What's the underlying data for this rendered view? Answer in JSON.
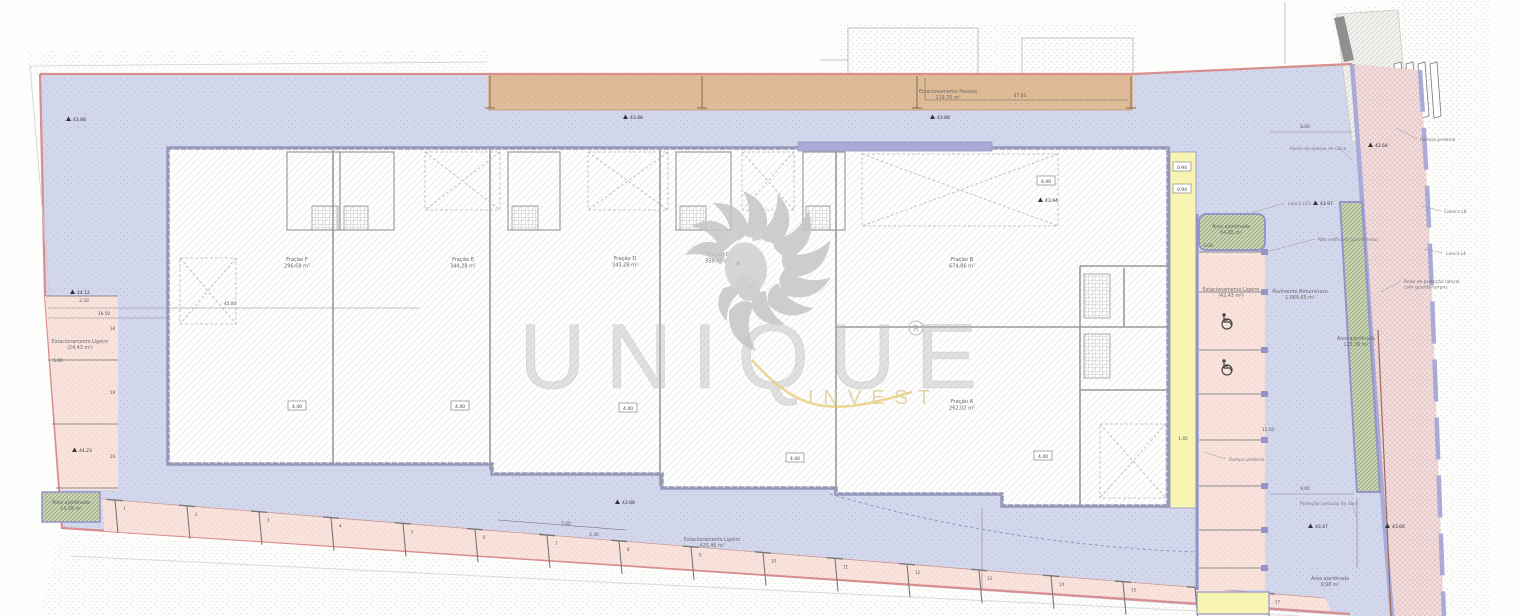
{
  "colors": {
    "site": "#d3d7ec",
    "site_dot": "#a9aed0",
    "boundary": "#d98d8d",
    "pavement_tan": "#dfbc97",
    "building_fill": "#ffffff",
    "wall_purple": "#9395c8",
    "band_purple": "#a9abd6",
    "wall_gray": "#9a9a9a",
    "yellow_walkway": "#f8f4b2",
    "parking_pink": "#f9e2dc",
    "garden_green": "#ccd6b4",
    "garden_line": "#93a37e",
    "road_pink": "#f3e0e0",
    "road_line": "#dfb9b9",
    "watermark_gray": "#c6c6c6",
    "watermark_gold": "#e5c96b",
    "text_gray": "#777777",
    "dim_gray": "#555555"
  },
  "watermark": {
    "brand": "UNIQUE",
    "registered": "®",
    "sub": "INVEST"
  },
  "units": [
    {
      "label": "Fração F",
      "area": "296,68 m²",
      "x": 297,
      "y": 261
    },
    {
      "label": "Fração E",
      "area": "344,28 m²",
      "x": 463,
      "y": 261
    },
    {
      "label": "Fração D",
      "area": "343,28 m²",
      "x": 625,
      "y": 260
    },
    {
      "label": "Fração C",
      "area": "359,40 m²",
      "x": 718,
      "y": 256
    },
    {
      "label": "Fração B",
      "area": "674,86 m²",
      "x": 962,
      "y": 261
    },
    {
      "label": "Fração A",
      "area": "262,02 m²",
      "x": 962,
      "y": 403
    }
  ],
  "area_labels": [
    {
      "lines": [
        "Estacionamento Passeio",
        "219,70 m²"
      ],
      "x": 948,
      "y": 93
    },
    {
      "lines": [
        "Estacionamento Ligeiro",
        "425,46 m²"
      ],
      "x": 712,
      "y": 541
    },
    {
      "lines": [
        "Estacionamento Ligeiro",
        "(42,43 m²)"
      ],
      "x": 1231,
      "y": 291
    },
    {
      "lines": [
        "Estacionamento Ligeiro",
        "(24,43 m²)"
      ],
      "x": 80,
      "y": 343
    },
    {
      "lines": [
        "Área ajardinada",
        "64,85 m²"
      ],
      "x": 1231,
      "y": 228
    },
    {
      "lines": [
        "Área ajardinada",
        "14,39 m²"
      ],
      "x": 71,
      "y": 504
    },
    {
      "lines": [
        "Área ajardinada",
        "115,36 m²"
      ],
      "x": 1356,
      "y": 340
    },
    {
      "lines": [
        "Área ajardinada",
        "9,98 m²"
      ],
      "x": 1330,
      "y": 580
    },
    {
      "lines": [
        "Pavimento Betuminoso",
        "1.664,65 m²"
      ],
      "x": 1300,
      "y": 293
    }
  ],
  "annotations": [
    {
      "lines": [
        "Lancil L43"
      ],
      "x": 1288,
      "y": 205,
      "l": [
        1285,
        203,
        1248,
        214
      ]
    },
    {
      "lines": [
        "Não edificado (pavimento)"
      ],
      "x": 1318,
      "y": 241,
      "l": [
        1315,
        239,
        1266,
        252
      ]
    },
    {
      "lines": [
        "Ponto de acesso de Obra"
      ],
      "x": 1290,
      "y": 150,
      "l": [
        1341,
        150,
        1352,
        160
      ]
    },
    {
      "lines": [
        "Rampa pedonal"
      ],
      "x": 1420,
      "y": 141,
      "l": [
        1417,
        139,
        1396,
        128
      ]
    },
    {
      "lines": [
        "Caleira L6"
      ],
      "x": 1444,
      "y": 213,
      "l": [
        1441,
        211,
        1421,
        206
      ]
    },
    {
      "lines": [
        "Lancil L4"
      ],
      "x": 1446,
      "y": 255,
      "l": [
        1443,
        253,
        1424,
        249
      ]
    },
    {
      "lines": [
        "Rede de proteção lateral",
        "com guarda-corpos"
      ],
      "x": 1404,
      "y": 283,
      "l": [
        1401,
        281,
        1381,
        292
      ]
    },
    {
      "lines": [
        "Rampa pedonal"
      ],
      "x": 1229,
      "y": 461,
      "l": [
        1226,
        459,
        1204,
        452
      ]
    },
    {
      "lines": [
        "Proteção pessoas de obra"
      ],
      "x": 1300,
      "y": 505,
      "l": [
        1352,
        503,
        1357,
        519
      ]
    }
  ],
  "levels": [
    {
      "v": "43.88",
      "x": 66,
      "y": 121
    },
    {
      "v": "43.88",
      "x": 623,
      "y": 119
    },
    {
      "v": "43.88",
      "x": 930,
      "y": 119
    },
    {
      "v": "43.94",
      "x": 1038,
      "y": 202
    },
    {
      "v": "43.97",
      "x": 1313,
      "y": 205
    },
    {
      "v": "43.64",
      "x": 1368,
      "y": 147
    },
    {
      "v": "44.12",
      "x": 70,
      "y": 294
    },
    {
      "v": "44.23",
      "x": 72,
      "y": 452
    },
    {
      "v": "43.88",
      "x": 615,
      "y": 504
    },
    {
      "v": "43.47",
      "x": 1308,
      "y": 528
    },
    {
      "v": "43.66",
      "x": 1385,
      "y": 528
    }
  ],
  "dims": [
    {
      "t": "47.65",
      "x": 1020,
      "y": 97
    },
    {
      "t": "45.00",
      "x": 230,
      "y": 305
    },
    {
      "t": "16.50",
      "x": 104,
      "y": 315
    },
    {
      "t": "5.00",
      "x": 566,
      "y": 525
    },
    {
      "t": "2.30",
      "x": 594,
      "y": 536
    },
    {
      "t": "8.00",
      "x": 1305,
      "y": 128
    },
    {
      "t": "8.00",
      "x": 1305,
      "y": 490
    },
    {
      "t": "5.00",
      "x": 1208,
      "y": 247
    },
    {
      "t": "11.10",
      "x": 1268,
      "y": 431
    },
    {
      "t": "1.45",
      "x": 1183,
      "y": 440
    },
    {
      "t": "2.50",
      "x": 84,
      "y": 302
    },
    {
      "t": "5.00",
      "x": 58,
      "y": 362
    }
  ],
  "boxed": [
    {
      "t": "4.40",
      "x": 297,
      "y": 407
    },
    {
      "t": "4.40",
      "x": 460,
      "y": 407
    },
    {
      "t": "4.40",
      "x": 628,
      "y": 409
    },
    {
      "t": "4.40",
      "x": 795,
      "y": 459
    },
    {
      "t": "4.40",
      "x": 1043,
      "y": 457
    },
    {
      "t": "4.40",
      "x": 1046,
      "y": 182
    },
    {
      "t": "0.94",
      "x": 1182,
      "y": 168
    },
    {
      "t": "0.94",
      "x": 1182,
      "y": 190
    }
  ],
  "parking_bottom": {
    "numbers": [
      "1",
      "2",
      "3",
      "4",
      "5",
      "6",
      "7",
      "8",
      "9",
      "10",
      "11",
      "12",
      "13",
      "14",
      "15",
      "16",
      "17"
    ]
  },
  "parking_left": {
    "numbers": [
      "18",
      "19",
      "20"
    ]
  }
}
